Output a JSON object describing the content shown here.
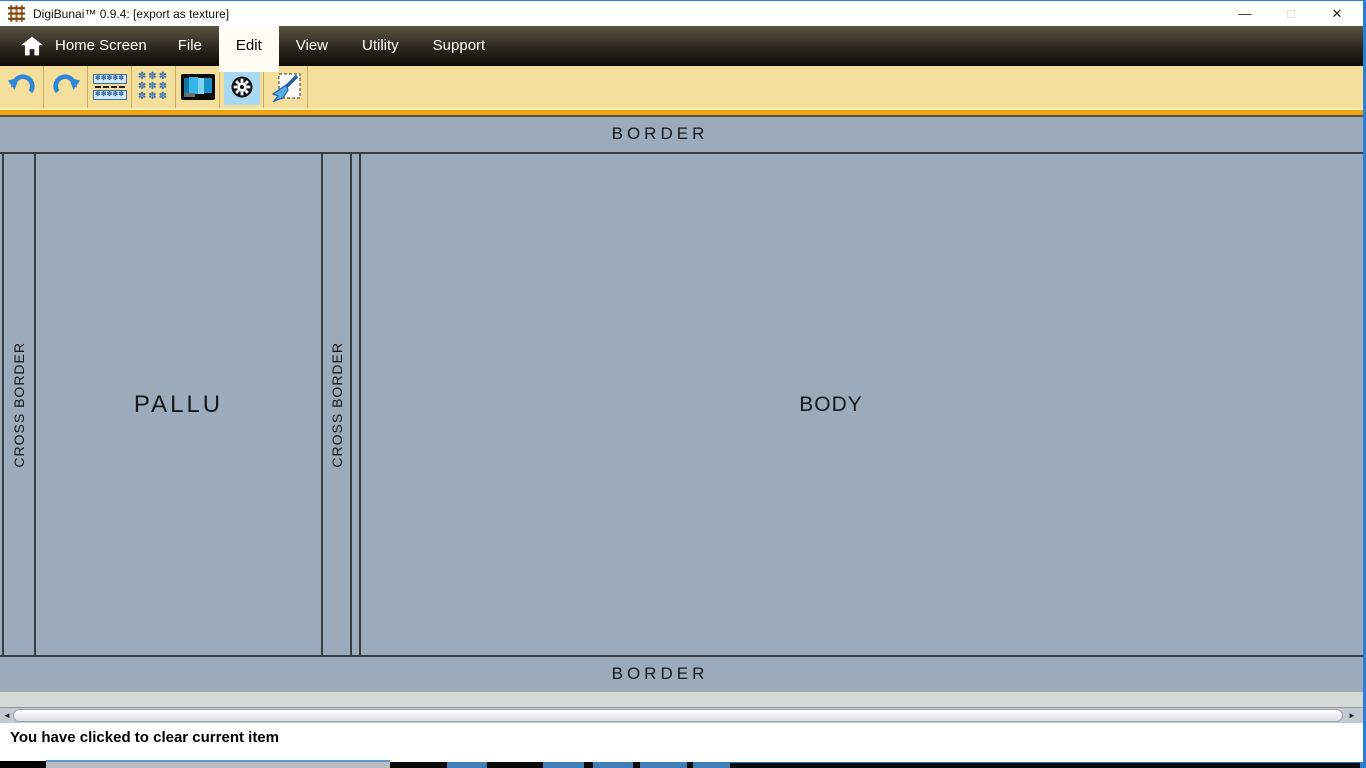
{
  "titlebar": {
    "title": "DigiBunai™ 0.9.4: [export as texture]",
    "minimize_glyph": "—",
    "maximize_glyph": "□",
    "close_glyph": "✕"
  },
  "menu": {
    "items": [
      {
        "label": "Home Screen",
        "active": false
      },
      {
        "label": "File",
        "active": false
      },
      {
        "label": "Edit",
        "active": true
      },
      {
        "label": "View",
        "active": false
      },
      {
        "label": "Utility",
        "active": false
      },
      {
        "label": "Support",
        "active": false
      }
    ]
  },
  "toolbar": {
    "buttons": [
      {
        "name": "undo"
      },
      {
        "name": "redo"
      },
      {
        "name": "border-design"
      },
      {
        "name": "motif-grid"
      },
      {
        "name": "artwork-view"
      },
      {
        "name": "settings-gear",
        "selected": true
      },
      {
        "name": "clear-canvas"
      }
    ],
    "right_button": {
      "name": "properties-list"
    },
    "background": "#f3df9b",
    "accent": "#f0a30c"
  },
  "canvas": {
    "border_top": "BORDER",
    "border_bottom": "BORDER",
    "cross_border_left": "CROSS BORDER",
    "pallu": "PALLU",
    "cross_border_mid": "CROSS BORDER",
    "body": "BODY",
    "background": "#9cabbc",
    "line_color": "#383d44"
  },
  "scrollbar": {
    "left_arrow": "◄",
    "right_arrow": "►"
  },
  "status": {
    "message": "You have clicked to clear current item"
  },
  "taskstrip": {
    "segments": [
      {
        "x": 0,
        "y": 1,
        "w": 46,
        "h": 7,
        "color": "#000000"
      },
      {
        "x": 46,
        "y": 0,
        "w": 344,
        "h": 2,
        "color": "#5e97d0"
      },
      {
        "x": 46,
        "y": 2,
        "w": 344,
        "h": 6,
        "color": "#b9bcbe"
      },
      {
        "x": 390,
        "y": 2,
        "w": 57,
        "h": 6,
        "color": "#0a0a0a"
      },
      {
        "x": 447,
        "y": 2,
        "w": 40,
        "h": 6,
        "color": "#3e7fb8"
      },
      {
        "x": 487,
        "y": 2,
        "w": 56,
        "h": 6,
        "color": "#0a0a0a"
      },
      {
        "x": 543,
        "y": 2,
        "w": 41,
        "h": 6,
        "color": "#3e7fb8"
      },
      {
        "x": 584,
        "y": 2,
        "w": 9,
        "h": 6,
        "color": "#0a0a0a"
      },
      {
        "x": 593,
        "y": 2,
        "w": 40,
        "h": 6,
        "color": "#3e7fb8"
      },
      {
        "x": 633,
        "y": 2,
        "w": 7,
        "h": 6,
        "color": "#0a0a0a"
      },
      {
        "x": 640,
        "y": 2,
        "w": 47,
        "h": 6,
        "color": "#3e7fb8"
      },
      {
        "x": 687,
        "y": 2,
        "w": 6,
        "h": 6,
        "color": "#0a0a0a"
      },
      {
        "x": 693,
        "y": 2,
        "w": 37,
        "h": 6,
        "color": "#3e7fb8"
      },
      {
        "x": 730,
        "y": 2,
        "w": 630,
        "h": 1,
        "color": "#2a6fb0"
      },
      {
        "x": 730,
        "y": 3,
        "w": 630,
        "h": 5,
        "color": "#0a0c10"
      },
      {
        "x": 1360,
        "y": 2,
        "w": 6,
        "h": 6,
        "color": "#2f7fd0"
      }
    ]
  }
}
